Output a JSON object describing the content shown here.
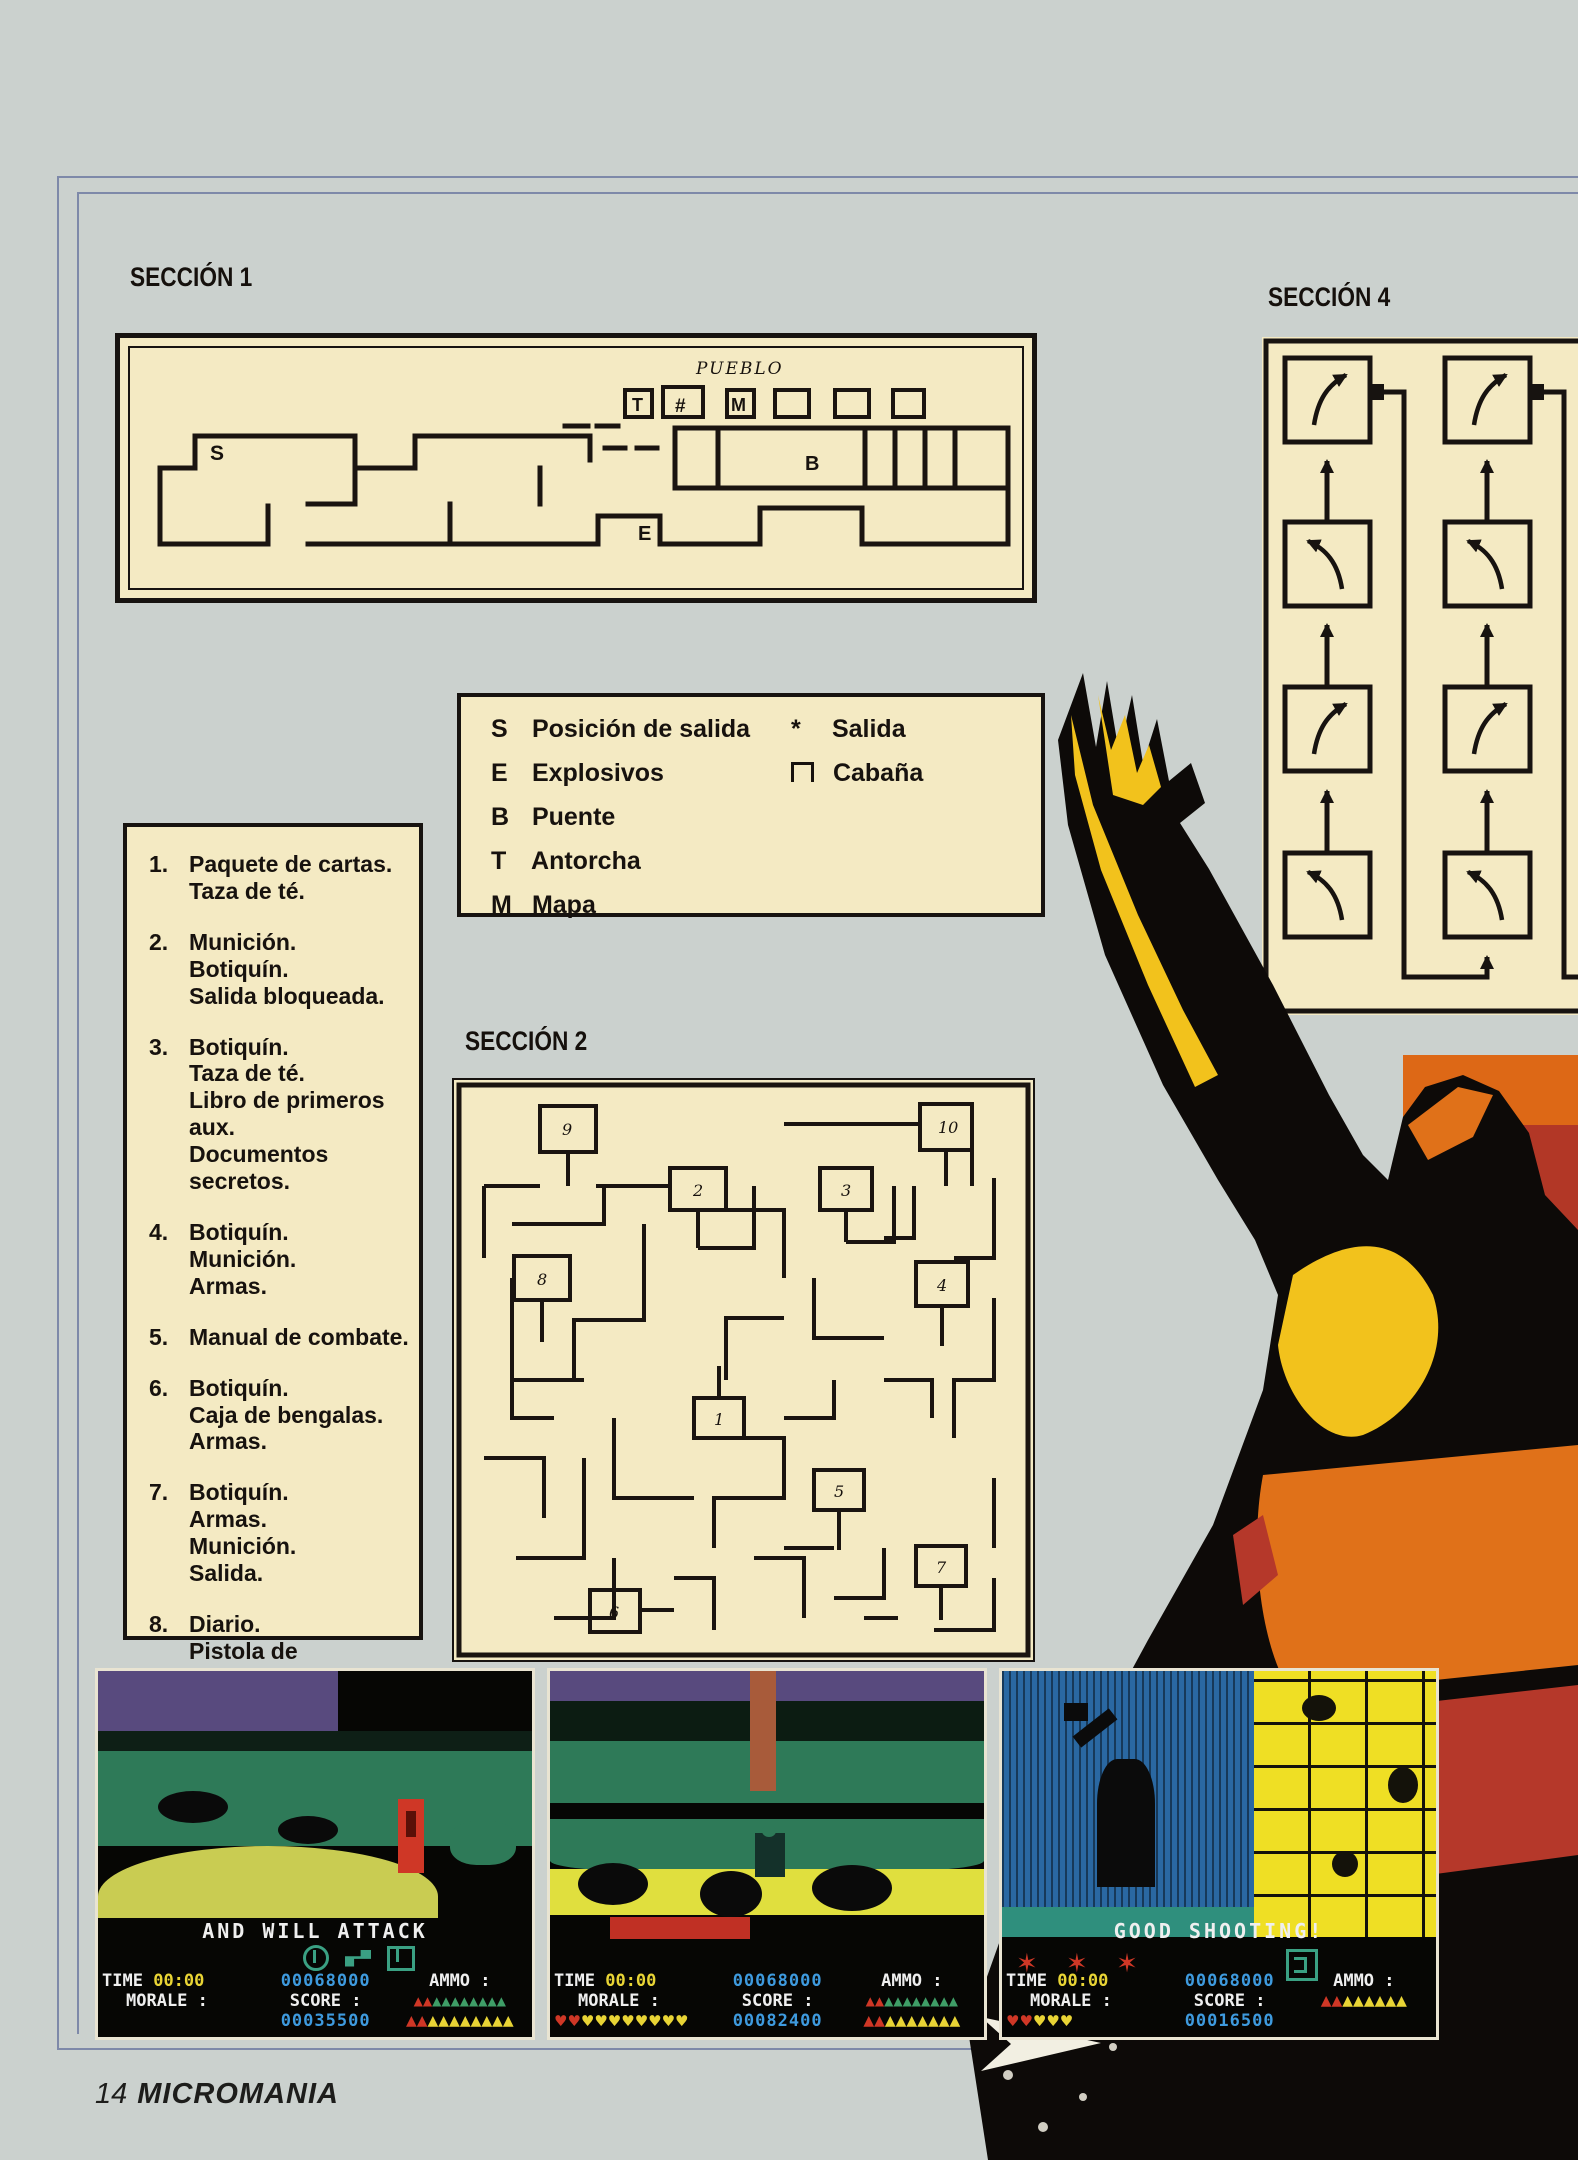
{
  "page": {
    "footer_page": "14",
    "footer_brand": "MICROMANIA"
  },
  "palette": {
    "page_bg": "#cbd1ce",
    "panel_bg": "#f4eac3",
    "ink": "#17120e",
    "frame_line": "#7e89a9",
    "hud_white": "#efefef",
    "hud_yellow": "#e8d435",
    "hud_blue": "#3e9ade",
    "hud_red": "#cf3726",
    "hud_green": "#3f9e67",
    "statue_yellow": "#f2c21c",
    "statue_orange": "#e07119",
    "statue_red": "#b5382a"
  },
  "sections": {
    "s1": "SECCIÓN 1",
    "s2": "SECCIÓN 2",
    "s4": "SECCIÓN 4"
  },
  "map1": {
    "pueblo": "PUEBLO",
    "hut_t": "T",
    "hut_bridge": "#",
    "hut_m": "M",
    "s": "S",
    "b": "B",
    "e": "E"
  },
  "legend": {
    "left": [
      {
        "key": "S",
        "label": "Posición de salida"
      },
      {
        "key": "E",
        "label": "Explosivos"
      },
      {
        "key": "B",
        "label": "Puente"
      },
      {
        "key": "T",
        "label": "Antorcha"
      },
      {
        "key": "M",
        "label": "Mapa"
      }
    ],
    "right": [
      {
        "key": "*",
        "label": "Salida"
      },
      {
        "key": "",
        "label": "Cabaña",
        "symbol": "cabin-square"
      }
    ]
  },
  "items": [
    {
      "num": "1.",
      "text": "Paquete de cartas.\nTaza de té."
    },
    {
      "num": "2.",
      "text": "Munición.\nBotiquín.\nSalida bloqueada."
    },
    {
      "num": "3.",
      "text": "Botiquín.\nTaza de té.\nLibro de primeros aux.\nDocumentos secretos."
    },
    {
      "num": "4.",
      "text": "Botiquín.\nMunición.\nArmas."
    },
    {
      "num": "5.",
      "text": "Manual de combate."
    },
    {
      "num": "6.",
      "text": "Botiquín.\nCaja de bengalas.\nArmas."
    },
    {
      "num": "7.",
      "text": "Botiquín.\nArmas.\nMunición.\nSalida."
    },
    {
      "num": "8.",
      "text": "Diario.\nPistola de bengalas."
    },
    {
      "num": "9.",
      "text": "Soldado wietnamita.\nBotas.\nDocumentos secretos.\nCaja de bengalas."
    }
  ],
  "maze": {
    "rooms": [
      "9",
      "10",
      "2",
      "3",
      "8",
      "4",
      "1",
      "5",
      "7",
      "6"
    ]
  },
  "screens": [
    {
      "message": "AND WILL ATTACK",
      "icons": [
        "compass-icon",
        "gun-icon",
        "map-icon"
      ],
      "hud": {
        "time_label": "TIME",
        "time": "00:00",
        "morale": "MORALE :",
        "score_top": "00068000",
        "score_label": "SCORE :",
        "score_bottom": "00035500",
        "ammo": "AMMO :",
        "hearts_red": "",
        "hearts_yellow": "",
        "ammo1_red": "▲▲",
        "ammo1_green": "▲▲▲▲▲▲▲▲",
        "ammo2_red": "▲▲",
        "ammo2_yellow": "▲▲▲▲▲▲▲▲"
      }
    },
    {
      "message": "",
      "hud": {
        "time_label": "TIME",
        "time": "00:00",
        "morale": "MORALE :",
        "score_top": "00068000",
        "score_label": "SCORE :",
        "score_bottom": "00082400",
        "ammo": "AMMO :",
        "hearts_red": "♥♥",
        "hearts_yellow": "♥♥♥♥♥♥♥♥",
        "ammo1_red": "▲▲",
        "ammo1_green": "▲▲▲▲▲▲▲▲",
        "ammo2_red": "▲▲",
        "ammo2_yellow": "▲▲▲▲▲▲▲"
      }
    },
    {
      "message": "GOOD SHOOTING!",
      "stars": "✶ ✶ ✶",
      "hud": {
        "time_label": "TIME",
        "time": "00:00",
        "morale": "MORALE :",
        "score_top": "00068000",
        "score_label": "SCORE :",
        "score_bottom": "00016500",
        "ammo": "AMMO :",
        "hearts_red": "♥♥",
        "hearts_yellow": "♥♥♥",
        "ammo1_red": "",
        "ammo1_green": "",
        "ammo2_red": "▲▲",
        "ammo2_yellow": "▲▲▲▲▲▲"
      }
    }
  ]
}
